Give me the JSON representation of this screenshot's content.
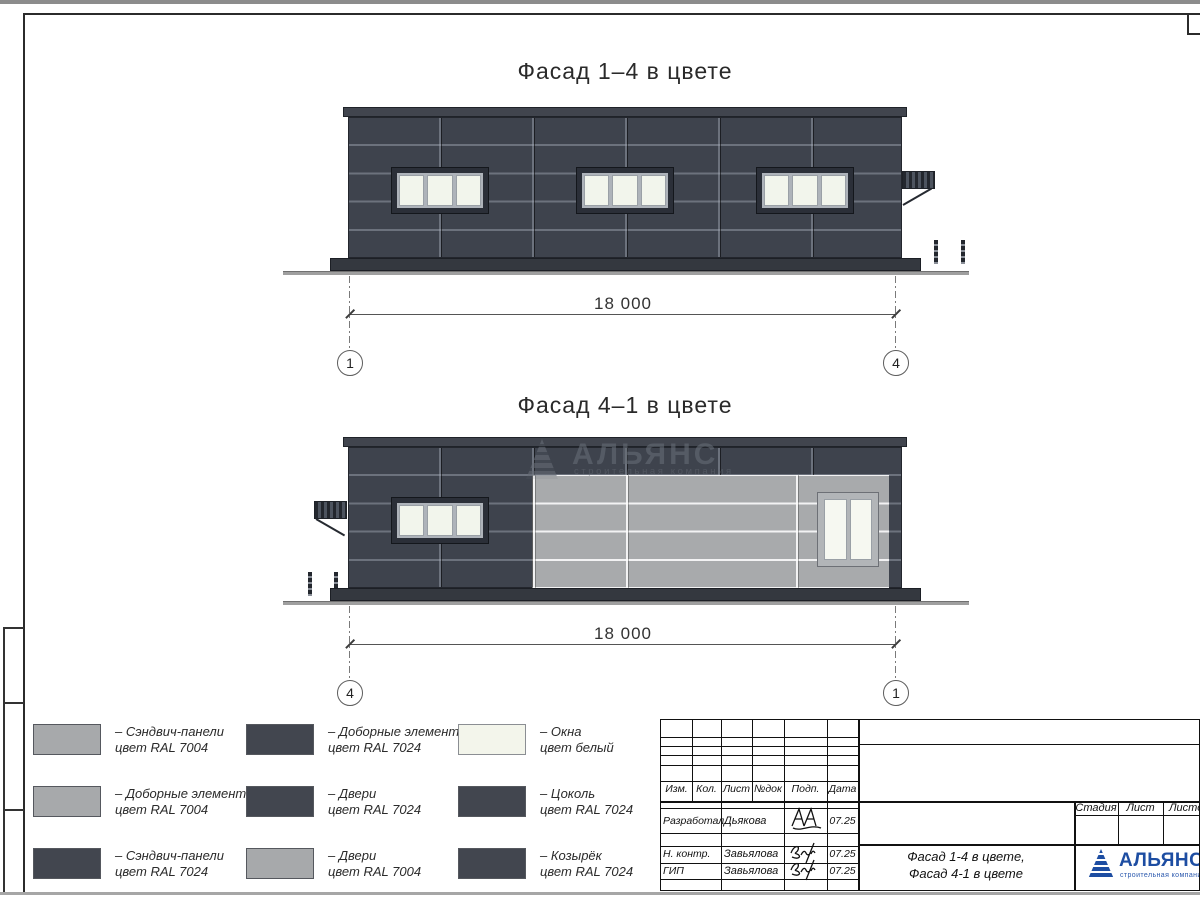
{
  "drawing": {
    "facade_top": {
      "title": "Фасад 1–4 в цвете",
      "dimension": "18 000",
      "axis_left": "1",
      "axis_right": "4"
    },
    "facade_bottom": {
      "title": "Фасад 4–1 в цвете",
      "dimension": "18 000",
      "axis_left": "4",
      "axis_right": "1"
    },
    "watermark": {
      "name": "АЛЬЯНС",
      "subtitle": "строительная компания"
    }
  },
  "legend": {
    "items": [
      {
        "color": "#a7a9ab",
        "label1": "– Сэндвич-панели",
        "label2": "цвет RAL 7004"
      },
      {
        "color": "#a7a9ab",
        "label1": "– Доборные элементы",
        "label2": "цвет RAL 7004"
      },
      {
        "color": "#42464f",
        "label1": "– Сэндвич-панели",
        "label2": "цвет RAL 7024"
      },
      {
        "color": "#42464f",
        "label1": "– Доборные элементы",
        "label2": "цвет RAL 7024"
      },
      {
        "color": "#42464f",
        "label1": "– Двери",
        "label2": "цвет RAL 7024"
      },
      {
        "color": "#a7a9ab",
        "label1": "– Двери",
        "label2": "цвет RAL 7004"
      },
      {
        "color": "#f3f5eb",
        "label1": "– Окна",
        "label2": "цвет белый"
      },
      {
        "color": "#42464f",
        "label1": "– Цоколь",
        "label2": "цвет RAL 7024"
      },
      {
        "color": "#42464f",
        "label1": "– Козырёк",
        "label2": "цвет RAL 7024"
      }
    ]
  },
  "titleblock": {
    "headers": [
      "Изм.",
      "Кол.",
      "Лист",
      "№док",
      "Подп.",
      "Дата"
    ],
    "signature_rows": [
      {
        "role": "Разработал",
        "name": "Дьякова",
        "date": "07.25"
      },
      {
        "role": "Н. контр.",
        "name": "Завьялова",
        "date": "07.25"
      },
      {
        "role": "ГИП",
        "name": "Завьялова",
        "date": "07.25"
      }
    ],
    "doc_title_line1": "Фасад 1-4 в цвете,",
    "doc_title_line2": "Фасад 4-1 в цвете",
    "stage_label": "Стадия",
    "sheet_label": "Лист",
    "sheets_label": "Листов",
    "company": {
      "name": "АЛЬЯНС",
      "subtitle": "строительная компания"
    }
  },
  "colors": {
    "ral7024": "#3e434d",
    "ral7004": "#a7a9ab",
    "window_white": "#f2f5ec",
    "logo_blue": "#1d4da2"
  }
}
